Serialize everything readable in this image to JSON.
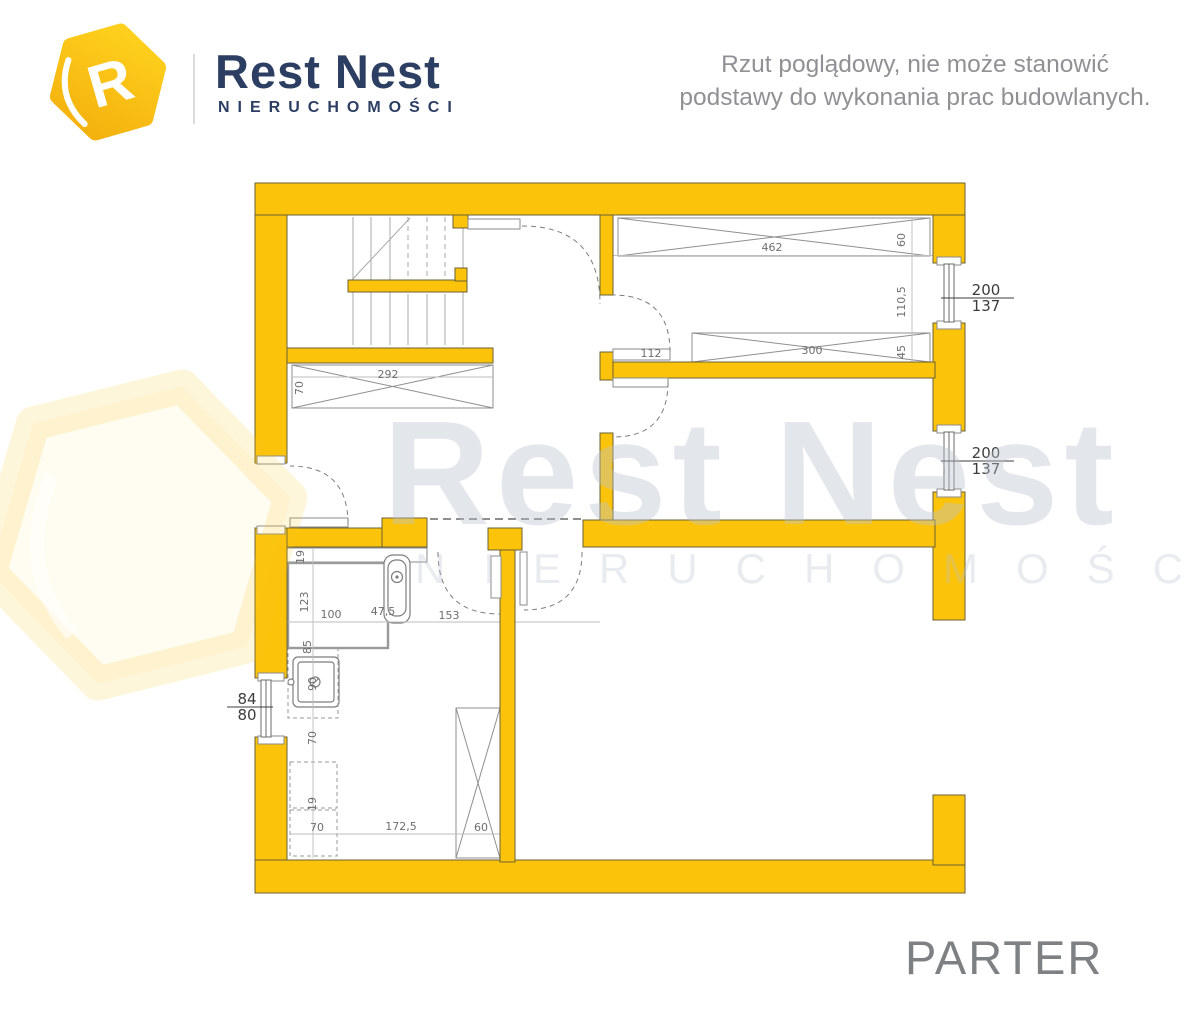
{
  "header": {
    "logo": {
      "letter": "R",
      "brand": "Rest Nest",
      "sub": "NIERUCHOMOŚCI"
    },
    "disclaimer_line1": "Rzut  poglądowy, nie może stanowić",
    "disclaimer_line2": "podstawy do wykonania prac budowlanych."
  },
  "watermark": {
    "brand": "Rest Nest",
    "sub": "NIERUCHOMOŚCI"
  },
  "plan": {
    "floor_label": "PARTER",
    "dim_labels": [
      {
        "text": "292",
        "x": 388,
        "y": 378
      },
      {
        "text": "70",
        "x": 303,
        "y": 388,
        "rot": -90
      },
      {
        "text": "462",
        "x": 772,
        "y": 251
      },
      {
        "text": "60",
        "x": 905,
        "y": 240,
        "rot": -90
      },
      {
        "text": "110,5",
        "x": 905,
        "y": 302,
        "rot": -90
      },
      {
        "text": "300",
        "x": 812,
        "y": 354
      },
      {
        "text": "45",
        "x": 905,
        "y": 352,
        "rot": -90
      },
      {
        "text": "112",
        "x": 651,
        "y": 357
      },
      {
        "text": "19",
        "x": 304,
        "y": 557,
        "rot": -90
      },
      {
        "text": "123",
        "x": 308,
        "y": 602,
        "rot": -90
      },
      {
        "text": "100",
        "x": 331,
        "y": 618
      },
      {
        "text": "47,5",
        "x": 383,
        "y": 615
      },
      {
        "text": "153",
        "x": 449,
        "y": 619
      },
      {
        "text": "85",
        "x": 311,
        "y": 647,
        "rot": -90
      },
      {
        "text": "90",
        "x": 316,
        "y": 684,
        "rot": -90
      },
      {
        "text": "70",
        "x": 316,
        "y": 738,
        "rot": -90
      },
      {
        "text": "19",
        "x": 316,
        "y": 804,
        "rot": -90
      },
      {
        "text": "70",
        "x": 317,
        "y": 831
      },
      {
        "text": "172,5",
        "x": 401,
        "y": 830
      },
      {
        "text": "60",
        "x": 481,
        "y": 831
      }
    ],
    "window_labels": [
      {
        "top": "200",
        "bottom": "137",
        "cx": 986,
        "top_y": 295,
        "bot_y": 311,
        "line_y": 298,
        "x1": 941,
        "x2": 1014
      },
      {
        "top": "200",
        "bottom": "137",
        "cx": 986,
        "top_y": 458,
        "bot_y": 474,
        "line_y": 461,
        "x1": 941,
        "x2": 1014
      },
      {
        "top": "84",
        "bottom": "80",
        "cx": 247,
        "top_y": 704,
        "bot_y": 720,
        "line_y": 707,
        "x1": 227,
        "x2": 273
      }
    ]
  },
  "colors": {
    "wall": "#FCC30B",
    "wall_outline": "#6a6036",
    "dim_text": "#6e6e6e",
    "brand_navy": "#2d3e63",
    "gray_text": "#8f9194",
    "floor_title": "#7e8184",
    "watermark_strong": "rgba(185,194,206,0.40)",
    "watermark_soft": "rgba(185,194,206,0.32)"
  }
}
